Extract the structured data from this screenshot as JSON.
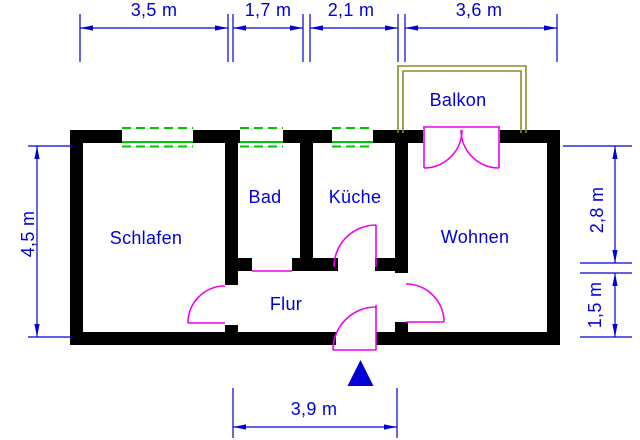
{
  "floorplan": {
    "rooms": {
      "schlafen": "Schlafen",
      "bad": "Bad",
      "kueche": "Küche",
      "wohnen": "Wohnen",
      "flur": "Flur",
      "balkon": "Balkon"
    },
    "dimensions": {
      "top": [
        "3,5 m",
        "1,7 m",
        "2,1 m",
        "3,6 m"
      ],
      "left": "4,5 m",
      "right": [
        "2,8 m",
        "1,5 m"
      ],
      "bottom": "3,9 m"
    },
    "colors": {
      "dimension_blue": "#0000d4",
      "wall_black": "#000000",
      "door_magenta": "#ee00ee",
      "window_green": "#00c400",
      "balcony_olive": "#8b8b2e",
      "background": "#ffffff"
    }
  }
}
